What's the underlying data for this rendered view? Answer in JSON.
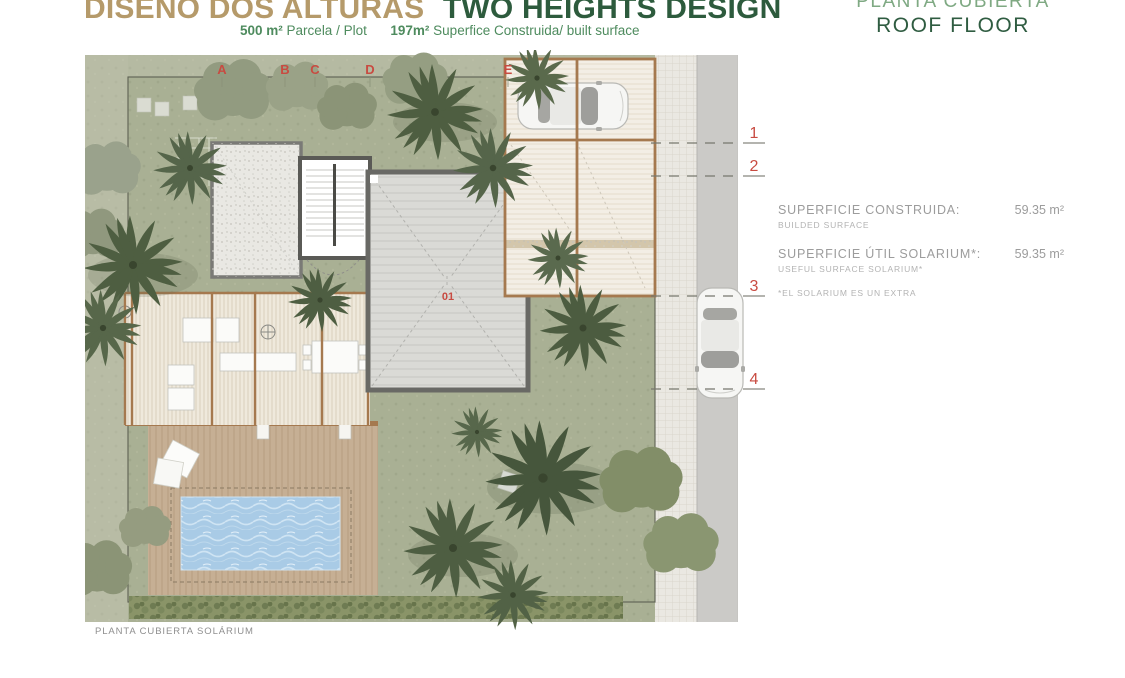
{
  "header": {
    "title_primary": "DISEÑO DOS ALTURAS",
    "title_secondary": "TWO HEIGHTS DESIGN",
    "subtitle": {
      "plot_value": "500 m²",
      "plot_label": "Parcela / Plot",
      "built_value": "197m²",
      "built_label": "Superfice Construida/ built surface"
    },
    "sheet_title_es": "PLANTA CUBIERTA",
    "sheet_title_en": "ROOF FLOOR"
  },
  "plan": {
    "grid_letters": [
      "A",
      "B",
      "C",
      "D",
      "E"
    ],
    "grid_numbers": [
      "1",
      "2",
      "3",
      "4"
    ],
    "unit_label": "01",
    "caption": "PLANTA CUBIERTA SOLÁRIUM"
  },
  "side_panel": {
    "rows": [
      {
        "label": "SUPERFICIE CONSTRUIDA:",
        "sublabel": "BUILDED SURFACE",
        "value": "59.35 m²"
      },
      {
        "label": "SUPERFICIE ÚTIL SOLARIUM*:",
        "sublabel": "USEFUL SURFACE SOLARIUM*",
        "value": "59.35 m²"
      }
    ],
    "note": "*EL SOLARIUM ES UN EXTRA"
  },
  "colors": {
    "accent_red": "#c84b41",
    "title_tan": "#b59a6a",
    "title_green": "#2d5b3d",
    "subtitle_green": "#4e8b5e",
    "sheet_light_green": "#7fa983",
    "label_gray": "#9c9c9c",
    "lawn_green": "#a9b094",
    "pool_blue": "#a9cbe6",
    "wood_brown": "#a5794f",
    "roof_gray": "#d9d9d5"
  }
}
